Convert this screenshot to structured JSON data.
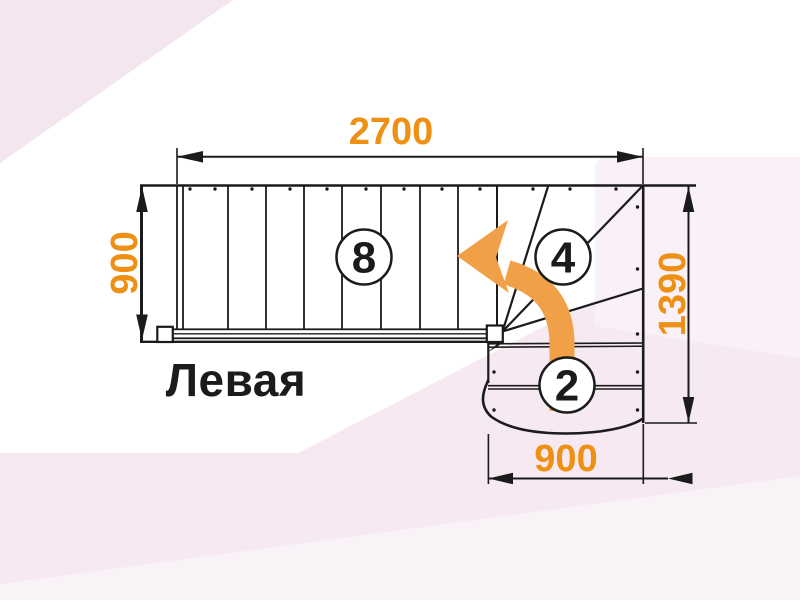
{
  "title": {
    "text": "Левая"
  },
  "dimensions": {
    "top_width_mm": "2700",
    "flight_width_mm": "900",
    "right_height_mm": "1390",
    "bottom_width_mm": "900"
  },
  "step_counts": {
    "straight_flight": "8",
    "winders": "4",
    "bottom_flight": "2"
  },
  "icons": {
    "direction_arrow": "turn-left-curved-arrow"
  },
  "colors": {
    "dimension_text": "#EE9014",
    "arrow_orange": "#F0A148",
    "line_black": "#1B1B1B",
    "background_white": "#FFFFFF",
    "background_pink": "#F6E9F2",
    "background_pink_corner": "#F3E6EF"
  }
}
